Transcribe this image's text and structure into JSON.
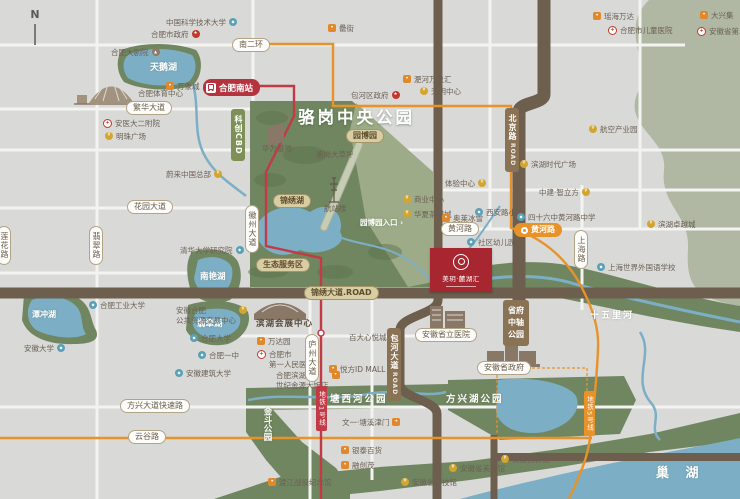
{
  "meta": {
    "compass": "N"
  },
  "park": {
    "title": "骆岗中央公园"
  },
  "station": {
    "name": "合肥南站"
  },
  "project": {
    "name": "美玥·麓湖汇"
  },
  "colors": {
    "bg": "#d9d9d7",
    "park_green": "#708660",
    "pale_green": "#9dab88",
    "olive": "#b0b7a3",
    "water": "#7cafc6",
    "road_brown": "#6d5e4d",
    "metro_red": "#c23a45",
    "metro_orange": "#e8922a",
    "project_red": "#a8262f"
  },
  "areas": [
    {
      "t": "天鹅湖",
      "x": 150,
      "y": 60,
      "fs": 9
    },
    {
      "t": "南艳湖",
      "x": 200,
      "y": 270,
      "fs": 8.5
    },
    {
      "t": "翡翠湖",
      "x": 197,
      "y": 317,
      "fs": 8.5
    },
    {
      "t": "潭冲湖",
      "x": 32,
      "y": 309,
      "fs": 8
    },
    {
      "t": "塘西河公园",
      "x": 330,
      "y": 391,
      "fs": 9.5,
      "ls": 2
    },
    {
      "t": "方兴湖公园",
      "x": 446,
      "y": 391,
      "fs": 9.5,
      "ls": 2
    },
    {
      "t": "金斗公园",
      "x": 261,
      "y": 407,
      "fs": 8.5,
      "v": true
    },
    {
      "t": "十五里河",
      "x": 590,
      "y": 308,
      "fs": 9,
      "ls": 2
    },
    {
      "t": "巢 湖",
      "x": 656,
      "y": 462,
      "fs": 13,
      "ls": 6
    },
    {
      "t": "园博园入口 ›",
      "x": 360,
      "y": 217,
      "fs": 7.5
    }
  ],
  "pills": [
    {
      "t": "南二环",
      "x": 232,
      "y": 38,
      "k": "white"
    },
    {
      "t": "繁华大道",
      "x": 126,
      "y": 101,
      "k": "white"
    },
    {
      "t": "花园大道",
      "x": 127,
      "y": 200,
      "k": "white"
    },
    {
      "t": "翡翠路",
      "x": 89,
      "y": 226,
      "k": "white",
      "v": true
    },
    {
      "t": "莲花路",
      "x": -3,
      "y": 226,
      "k": "white",
      "v": true
    },
    {
      "t": "徽州大道",
      "x": 245,
      "y": 205,
      "k": "white",
      "v": true
    },
    {
      "t": "黄河路",
      "x": 441,
      "y": 222,
      "k": "white"
    },
    {
      "t": "上海路",
      "x": 574,
      "y": 230,
      "k": "white",
      "v": true
    },
    {
      "t": "方兴大道快速路",
      "x": 120,
      "y": 399,
      "k": "white"
    },
    {
      "t": "云谷路",
      "x": 128,
      "y": 430,
      "k": "white"
    },
    {
      "t": "庐州大道",
      "x": 305,
      "y": 334,
      "k": "white",
      "v": true
    },
    {
      "t": "锦绣大道.ROAD",
      "x": 304,
      "y": 286,
      "k": "tan"
    },
    {
      "t": "锦绣湖",
      "x": 273,
      "y": 194,
      "k": "tan"
    },
    {
      "t": "园博园",
      "x": 346,
      "y": 129,
      "k": "tan"
    },
    {
      "t": "生态服务区",
      "x": 256,
      "y": 258,
      "k": "tan"
    },
    {
      "t": "北京路",
      "sub": "ROAD",
      "x": 505,
      "y": 108,
      "k": "brown",
      "v": true
    },
    {
      "t": "包河大道",
      "sub": "ROAD",
      "x": 387,
      "y": 328,
      "k": "brown",
      "v": true
    },
    {
      "t": "省府中轴公园",
      "x": 503,
      "y": 300,
      "k": "brown2"
    },
    {
      "t": "科创CBD",
      "x": 231,
      "y": 109,
      "k": "green",
      "v": true
    },
    {
      "t": "黄河路",
      "x": 514,
      "y": 223,
      "k": "orange"
    },
    {
      "t": "地铁1号线",
      "x": 316,
      "y": 386,
      "k": "redtag",
      "v": true
    },
    {
      "t": "地铁5号线",
      "x": 584,
      "y": 391,
      "k": "orangetag",
      "v": true
    },
    {
      "t": "安徽省政府",
      "x": 477,
      "y": 361,
      "k": "white"
    },
    {
      "t": "安徽省立医院",
      "x": 415,
      "y": 328,
      "k": "white"
    },
    {
      "t": "滨湖会展中心",
      "x": 250,
      "y": 318,
      "k": "plain"
    }
  ],
  "pois": [
    {
      "t": "中国科学技术大学",
      "x": 166,
      "y": 18,
      "ic": "school",
      "side": "r"
    },
    {
      "t": "合肥市政府",
      "x": 151,
      "y": 30,
      "ic": "gov",
      "side": "r"
    },
    {
      "t": "合肥大剧院",
      "x": 111,
      "y": 48,
      "ic": "landmark",
      "side": "r"
    },
    {
      "t": "万象城",
      "x": 166,
      "y": 82,
      "ic": "shop",
      "side": "l"
    },
    {
      "t": "合肥体育中心",
      "x": 138,
      "y": 89,
      "ic": "none",
      "side": "l"
    },
    {
      "t": "安医大二附院",
      "x": 103,
      "y": 119,
      "ic": "cross",
      "side": "l"
    },
    {
      "t": "明珠广场",
      "x": 105,
      "y": 132,
      "ic": "gold",
      "side": "l"
    },
    {
      "t": "罍街",
      "x": 328,
      "y": 24,
      "ic": "shop",
      "side": "l"
    },
    {
      "t": "包河区政府",
      "x": 351,
      "y": 91,
      "ic": "gov",
      "side": "r"
    },
    {
      "t": "淝河万象汇",
      "x": 403,
      "y": 75,
      "ic": "shop",
      "side": "l"
    },
    {
      "t": "天玥中心",
      "x": 420,
      "y": 87,
      "ic": "gold",
      "side": "l"
    },
    {
      "t": "瑶海万达",
      "x": 593,
      "y": 12,
      "ic": "shop",
      "side": "l"
    },
    {
      "t": "合肥市儿童医院",
      "x": 608,
      "y": 26,
      "ic": "cross",
      "side": "l"
    },
    {
      "t": "大兴集",
      "x": 700,
      "y": 11,
      "ic": "shop",
      "side": "l"
    },
    {
      "t": "安徽省第二人民医院",
      "x": 697,
      "y": 27,
      "ic": "cross",
      "side": "l"
    },
    {
      "t": "蔚来中国总部",
      "x": 166,
      "y": 170,
      "ic": "gold",
      "side": "r"
    },
    {
      "t": "清华大学研究院",
      "x": 180,
      "y": 246,
      "ic": "school",
      "side": "r"
    },
    {
      "t": "合肥工业大学",
      "x": 89,
      "y": 301,
      "ic": "school",
      "side": "l"
    },
    {
      "t": "安徽合肥",
      "t2": "公共资源交易中心",
      "x": 176,
      "y": 306,
      "ic": "gold",
      "side": "r"
    },
    {
      "t": "安徽大学",
      "x": 24,
      "y": 344,
      "ic": "school",
      "side": "r"
    },
    {
      "t": "合肥大学",
      "x": 190,
      "y": 334,
      "ic": "school",
      "side": "l"
    },
    {
      "t": "合肥一中",
      "x": 198,
      "y": 351,
      "ic": "school",
      "side": "l"
    },
    {
      "t": "安徽建筑大学",
      "x": 175,
      "y": 369,
      "ic": "school",
      "side": "l"
    },
    {
      "t": "华为基地",
      "x": 262,
      "y": 144,
      "ic": "none",
      "side": "l"
    },
    {
      "t": "骆岗大草坪",
      "x": 316,
      "y": 150,
      "ic": "none",
      "side": "l"
    },
    {
      "t": "航站楼",
      "x": 324,
      "y": 204,
      "ic": "none",
      "side": "l"
    },
    {
      "t": "体验中心",
      "x": 445,
      "y": 179,
      "ic": "gold",
      "side": "r"
    },
    {
      "t": "商业中心",
      "x": 403,
      "y": 195,
      "ic": "gold",
      "side": "l"
    },
    {
      "t": "华夏茶博城",
      "x": 403,
      "y": 210,
      "ic": "gold",
      "side": "l"
    },
    {
      "t": "奥莱冰雪",
      "x": 442,
      "y": 214,
      "ic": "shop",
      "side": "l"
    },
    {
      "t": "西安路小学",
      "x": 475,
      "y": 208,
      "ic": "school",
      "side": "l"
    },
    {
      "t": "社区幼儿园",
      "x": 467,
      "y": 238,
      "ic": "school",
      "side": "l"
    },
    {
      "t": "四十六中黄河路中学",
      "x": 517,
      "y": 213,
      "ic": "school",
      "side": "l"
    },
    {
      "t": "中建·智立方",
      "x": 539,
      "y": 188,
      "ic": "gold",
      "side": "r"
    },
    {
      "t": "滨湖卓越城",
      "x": 647,
      "y": 220,
      "ic": "gold",
      "side": "l"
    },
    {
      "t": "上海世界外国语学校",
      "x": 597,
      "y": 263,
      "ic": "school",
      "side": "l"
    },
    {
      "t": "滨湖时代广场",
      "x": 520,
      "y": 160,
      "ic": "gold",
      "side": "l"
    },
    {
      "t": "航空产业园",
      "x": 589,
      "y": 125,
      "ic": "gold",
      "side": "l"
    },
    {
      "t": "万达园",
      "x": 257,
      "y": 337,
      "ic": "shop",
      "side": "l"
    },
    {
      "t": "合肥市",
      "t2": "第一人民医院",
      "x": 257,
      "y": 350,
      "ic": "cross",
      "side": "l"
    },
    {
      "t": "合肥滨湖",
      "t2": "世纪金源大饭店",
      "x": 276,
      "y": 371,
      "ic": "shop",
      "side": "r"
    },
    {
      "t": "百大心悦城",
      "x": 349,
      "y": 333,
      "ic": "shop",
      "side": "r"
    },
    {
      "t": "悦方ID MALL",
      "x": 329,
      "y": 365,
      "ic": "shop",
      "side": "l"
    },
    {
      "t": "文一·塘溪津门",
      "x": 342,
      "y": 418,
      "ic": "shop",
      "side": "r"
    },
    {
      "t": "银泰百货",
      "x": 341,
      "y": 446,
      "ic": "shop",
      "side": "l"
    },
    {
      "t": "融创茂",
      "x": 341,
      "y": 461,
      "ic": "shop",
      "side": "l"
    },
    {
      "t": "渡江战役纪念馆",
      "x": 268,
      "y": 478,
      "ic": "shop",
      "side": "l"
    },
    {
      "t": "安徽省科技馆",
      "x": 401,
      "y": 478,
      "ic": "gold",
      "side": "l"
    },
    {
      "t": "安徽省美术馆",
      "x": 449,
      "y": 464,
      "ic": "gold",
      "side": "l"
    },
    {
      "t": "安徽创新馆",
      "x": 501,
      "y": 455,
      "ic": "gold",
      "side": "l"
    }
  ]
}
